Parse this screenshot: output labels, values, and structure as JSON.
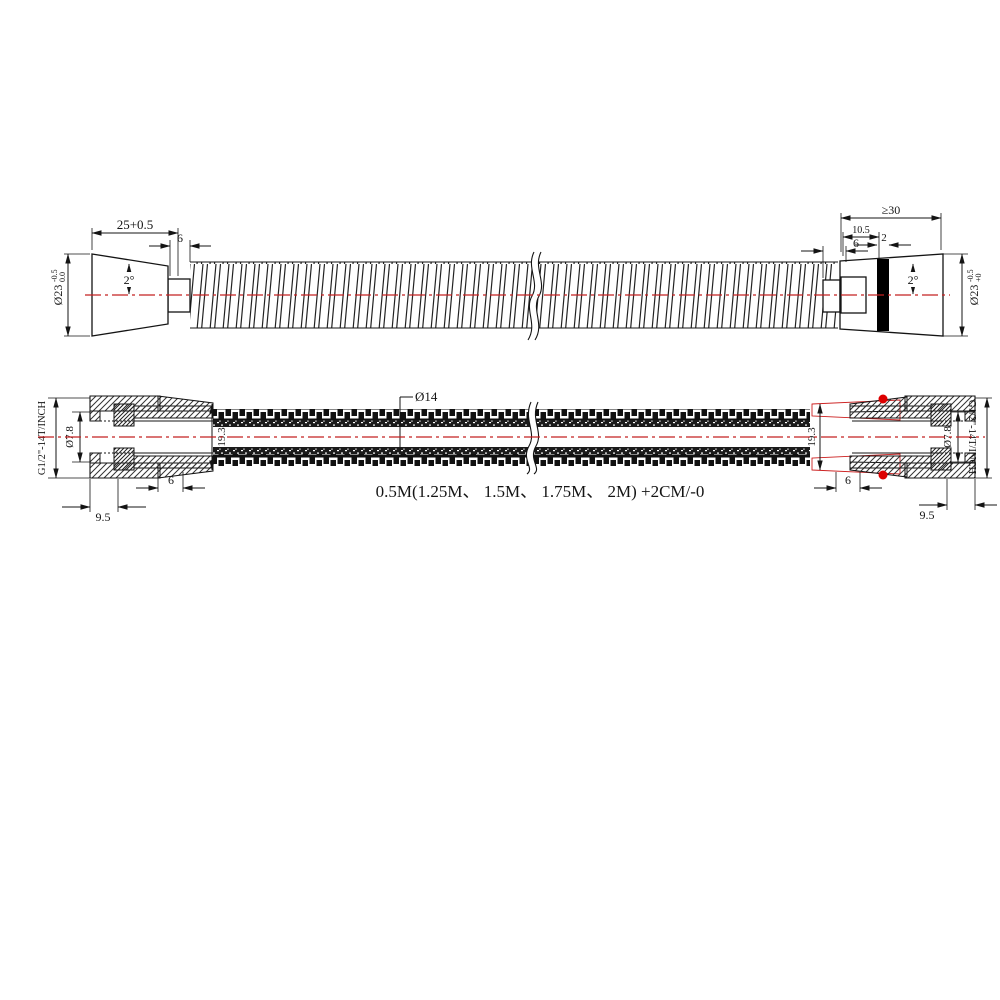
{
  "colors": {
    "centerline": "#c32020",
    "red_detail": "#cc2020",
    "drawing_line": "#141414",
    "band": "#000000"
  },
  "top_view": {
    "dims": {
      "length": "25+0.5",
      "collar": "6",
      "taper_left": "2°",
      "dia_left_prefix": "Ø23",
      "dia_left_sup": "-0.5",
      "dia_left_sub": "0.0",
      "min_len": "≥30",
      "offset": "10.5",
      "band": "2",
      "collar_right": "6",
      "taper_right": "2°",
      "dia_right_prefix": "Ø23",
      "dia_right_sup": "-0.5",
      "dia_right_sub": "+0"
    }
  },
  "section_view": {
    "dims": {
      "thread_left": "G1/2\"-14T/INCH",
      "bore_left": "Ø7.8",
      "od_left": "19.3",
      "insert_left": "6",
      "nut_left": "9.5",
      "inner_dia": "Ø14",
      "length_note": "0.5M(1.25M、 1.5M、 1.75M、 2M) +2CM/-0",
      "od_right": "19.3",
      "insert_right": "6",
      "nut_right": "9.5",
      "bore_right": "Ø7.8",
      "thread_right": "G1/2\"-14T/INCH"
    }
  }
}
